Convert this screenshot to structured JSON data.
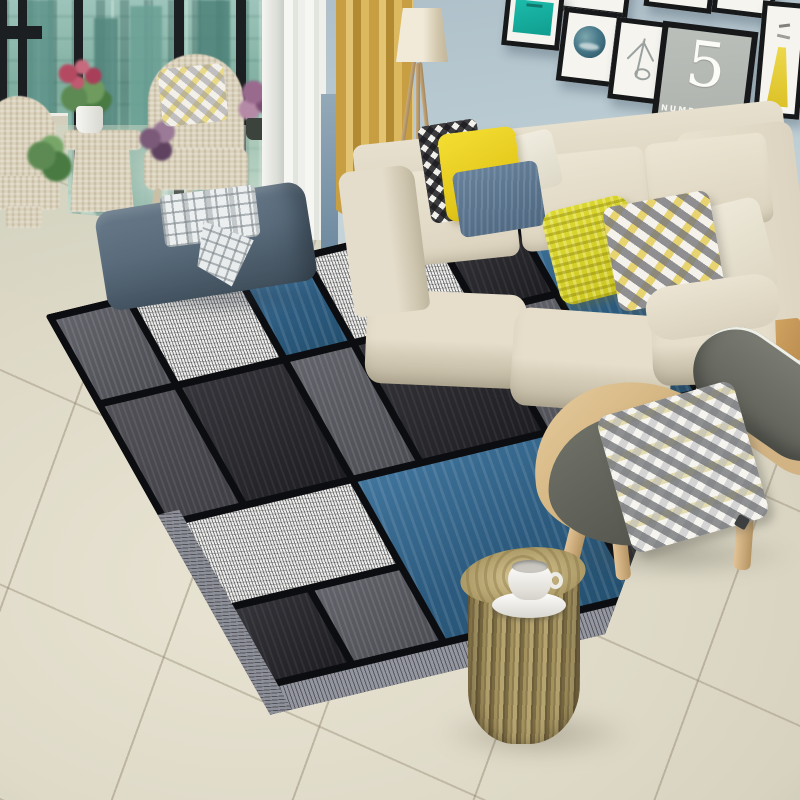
{
  "scene": {
    "description": "Modern living room product photo: geometric patchwork area rug in blue, charcoal, gray and white, beige three-seat sofa with yellow accent pillows, blue ottoman with plaid throw, wood lounge chair, log side table with coffee cup, wicker balcony chairs by a city-view window, and a black-framed gallery wall."
  },
  "wall_art": {
    "number_five_frame": {
      "digit": "5",
      "caption": "NUMBERFIVE"
    },
    "frames": [
      {
        "name": "top-row-frame-1"
      },
      {
        "name": "top-row-frame-2"
      },
      {
        "name": "top-row-frame-3"
      },
      {
        "name": "teal-abstract-print"
      },
      {
        "name": "circle-landscape-print"
      },
      {
        "name": "antler-sketch-print"
      },
      {
        "name": "number-five-print"
      },
      {
        "name": "yellow-figure-print"
      }
    ]
  },
  "palette": {
    "wall": "#bcc9cf",
    "floor_tile": "#ded9c8",
    "rug_blue": "#34658a",
    "rug_charcoal": "#26262b",
    "rug_gray": "#5a5a62",
    "rug_white": "#ededec",
    "rug_grid_black": "#0c0d10",
    "rug_edge_gray": "#9496a0",
    "sofa_cream": "#ddd5c2",
    "pillow_yellow": "#ecd51f",
    "pillow_blue_gray": "#5b7286",
    "ottoman_blue": "#5a6c7c",
    "curtain_yellow": "#cfa94a",
    "art_teal": "#14b2a3",
    "wood_light": "#d2b384",
    "window_view_teal": "#7fae9f",
    "chair_gray": "#6e7067"
  },
  "objects": [
    "city-window",
    "wicker-armchairs",
    "potted-plants",
    "sheer-curtain",
    "yellow-curtain",
    "floor-lamp",
    "gallery-wall",
    "beige-sofa",
    "accent-pillows",
    "plaid-throw",
    "blue-ottoman",
    "geometric-area-rug",
    "wood-lounge-chair",
    "triangle-print-pillow",
    "log-side-table",
    "white-coffee-cup",
    "tile-floor"
  ]
}
